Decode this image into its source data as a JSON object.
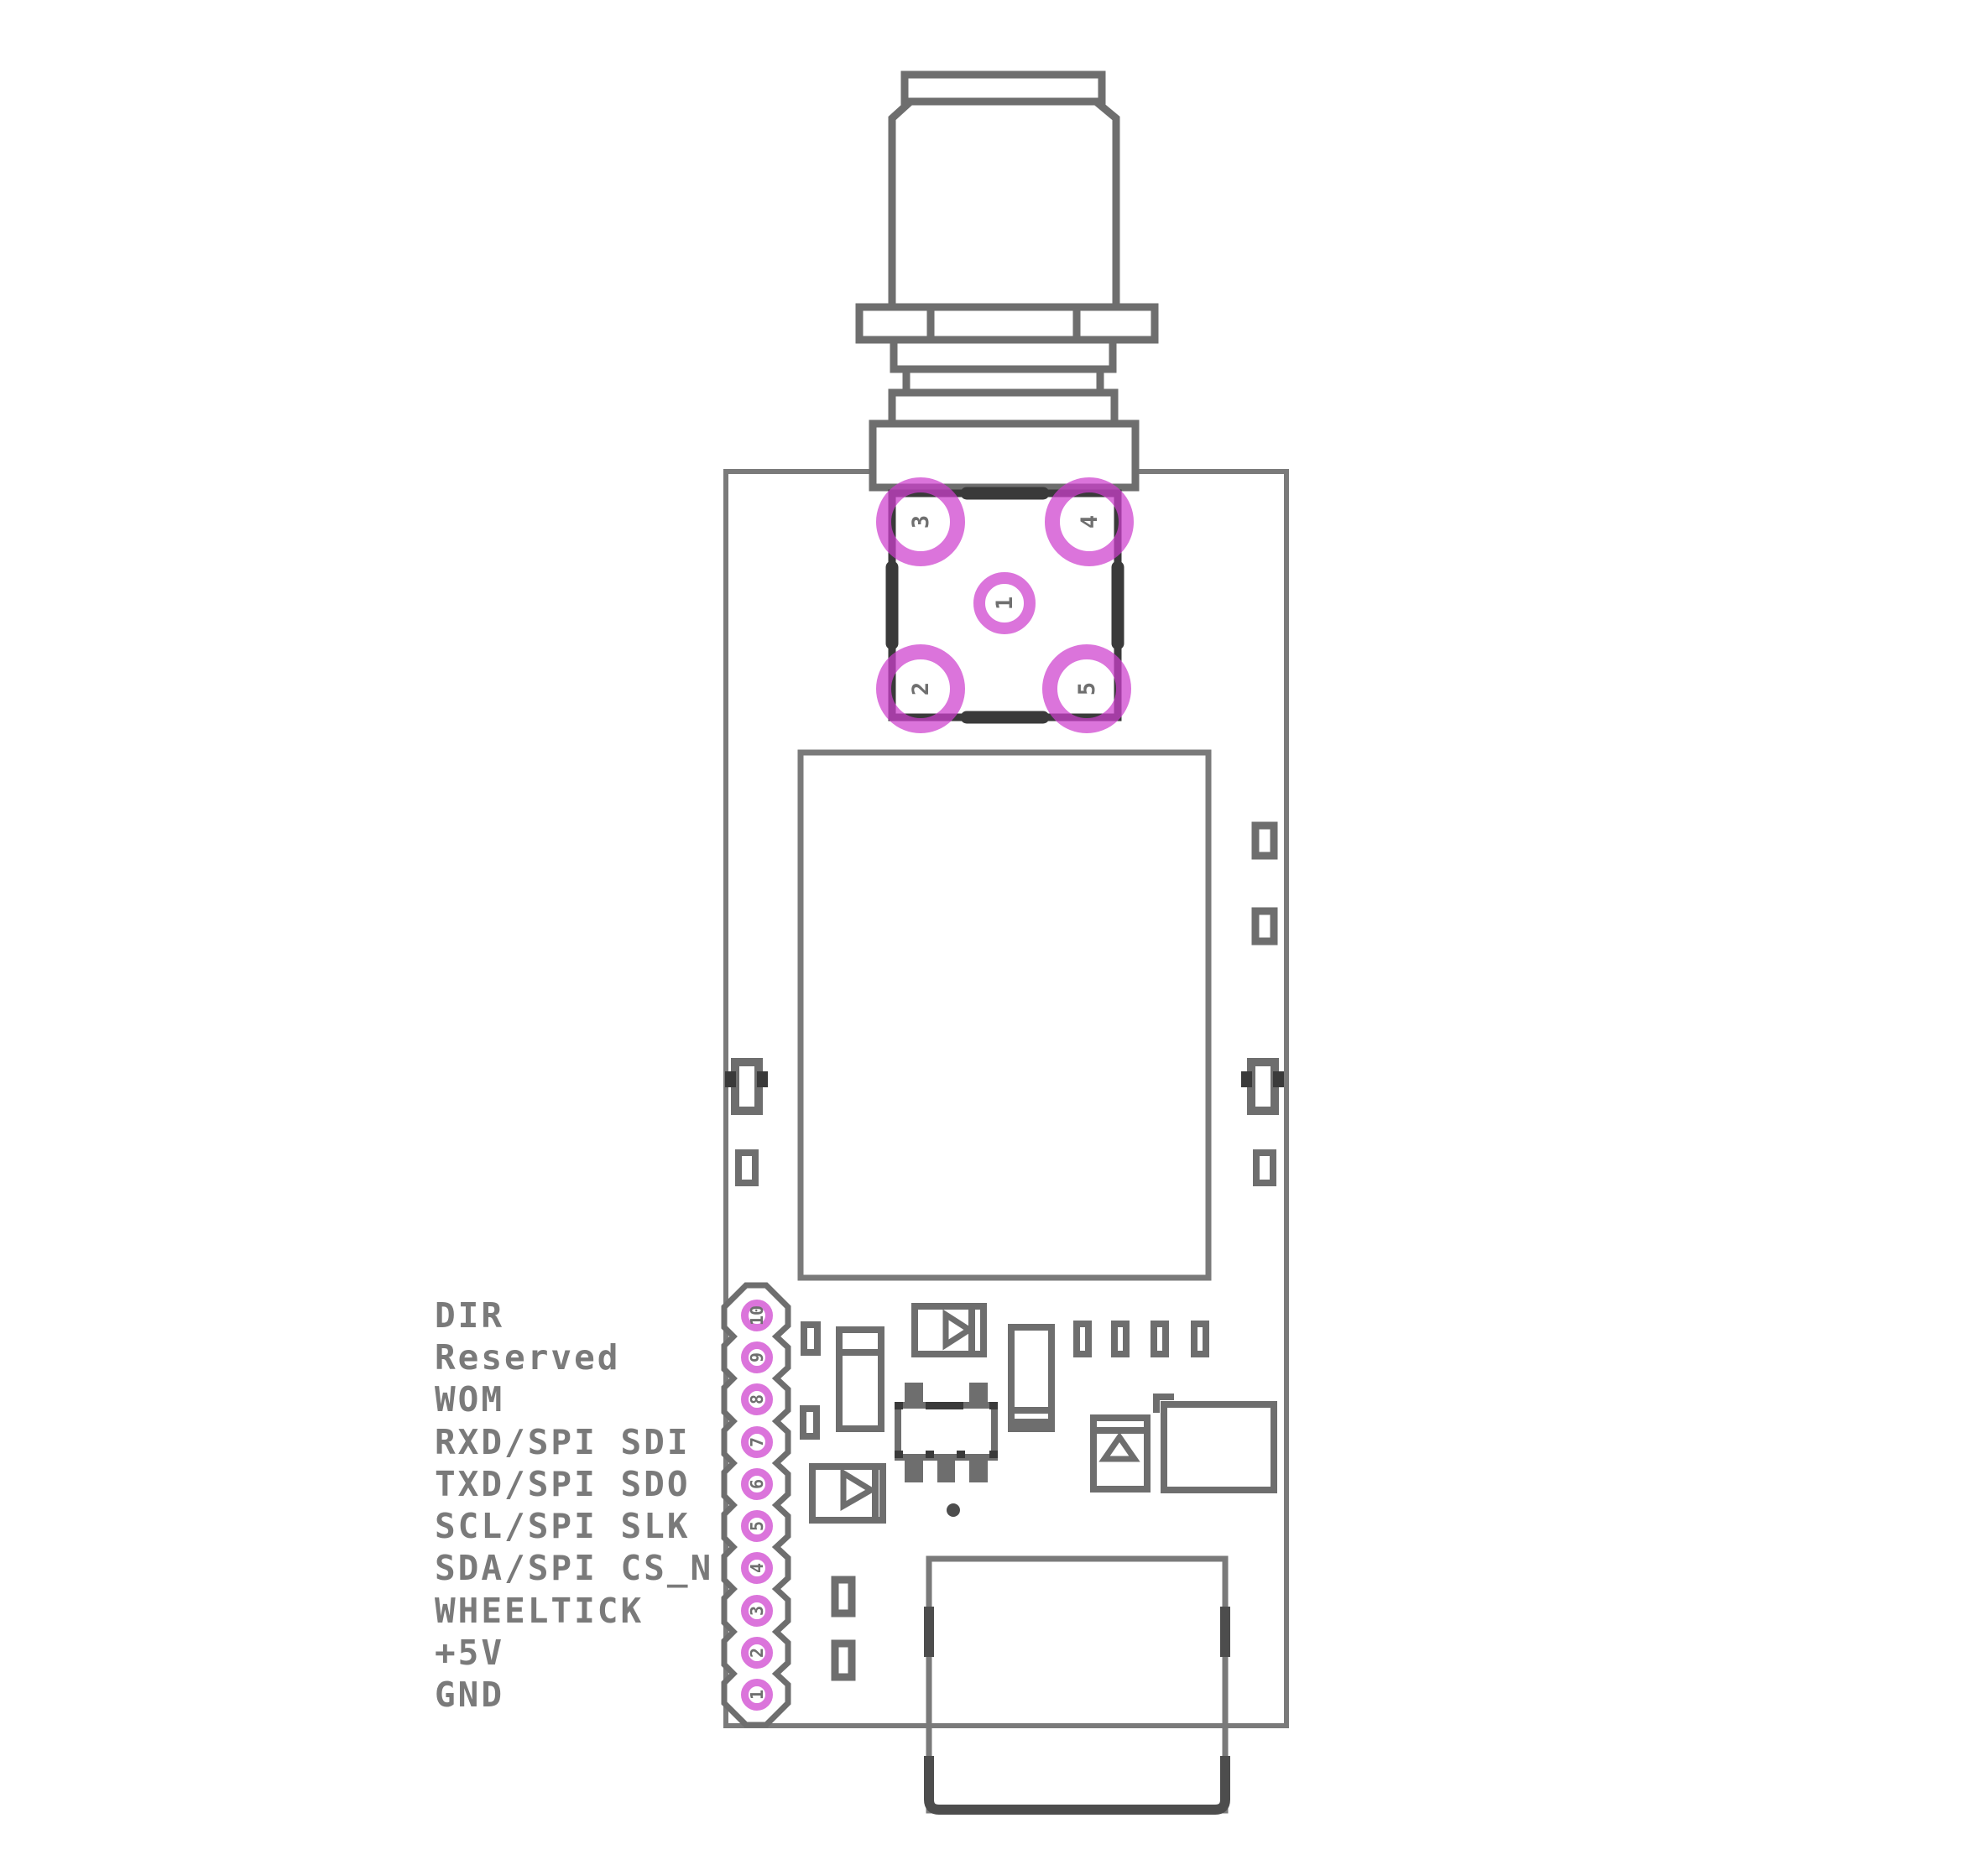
{
  "diagram": {
    "title": "GNSS dongle PCB component placement drawing",
    "board_name": "pcb-board-outline"
  },
  "colors": {
    "background": "#ffffff",
    "board_outline": "#7a7a7a",
    "component_outline": "#6e6e6e",
    "dark_silk": "#3a3a3a",
    "shell_dark": "#4d4d4d",
    "pad_purple": "rgba(205,62,205,0.72)",
    "label_text": "#7a7a7a",
    "pad_number_text": "#6f6f6f"
  },
  "antenna": {
    "name": "SMA antenna connector"
  },
  "sma_footprint": {
    "name": "SMA connector footprint",
    "pads": [
      {
        "number": "1"
      },
      {
        "number": "2"
      },
      {
        "number": "3"
      },
      {
        "number": "4"
      },
      {
        "number": "5"
      }
    ]
  },
  "module": {
    "name": "GNSS module shield outline"
  },
  "usb": {
    "name": "USB connector"
  },
  "header": {
    "name": "10-pin header",
    "pins": [
      {
        "number": "1",
        "label": "GND"
      },
      {
        "number": "2",
        "label": "+5V"
      },
      {
        "number": "3",
        "label": "WHEELTICK"
      },
      {
        "number": "4",
        "label": "SDA/SPI CS_N"
      },
      {
        "number": "5",
        "label": "SCL/SPI SLK"
      },
      {
        "number": "6",
        "label": "TXD/SPI SDO"
      },
      {
        "number": "7",
        "label": "RXD/SPI SDI"
      },
      {
        "number": "8",
        "label": "WOM"
      },
      {
        "number": "9",
        "label": "Reserved"
      },
      {
        "number": "10",
        "label": "DIR"
      }
    ]
  }
}
